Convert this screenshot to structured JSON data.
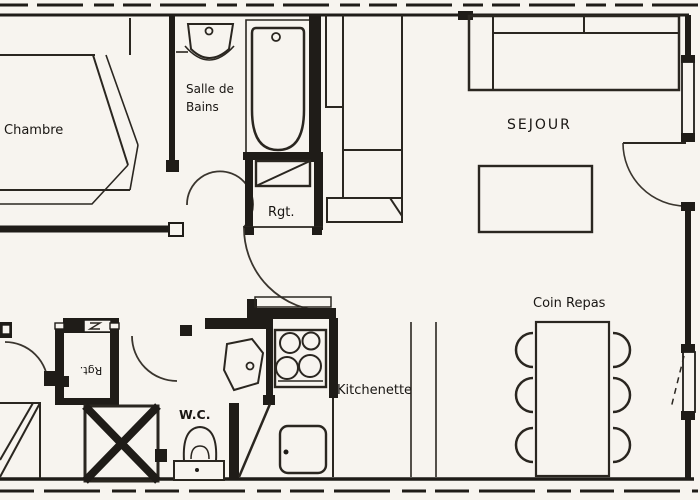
{
  "colors": {
    "background": "#f7f4ef",
    "line": "#1f1c18"
  },
  "rooms": {
    "chambre": {
      "label": "Chambre"
    },
    "salle_de_bains": {
      "label_line1": "Salle de",
      "label_line2": "Bains"
    },
    "sejour": {
      "label": "SEJOUR"
    },
    "rangement": {
      "label": "Rgt."
    },
    "rangement_entree": {
      "label": "Rgt."
    },
    "kitchenette": {
      "label": "Kitchenette"
    },
    "wc": {
      "label": "W.C."
    },
    "coin_repas": {
      "label": "Coin Repas"
    }
  }
}
